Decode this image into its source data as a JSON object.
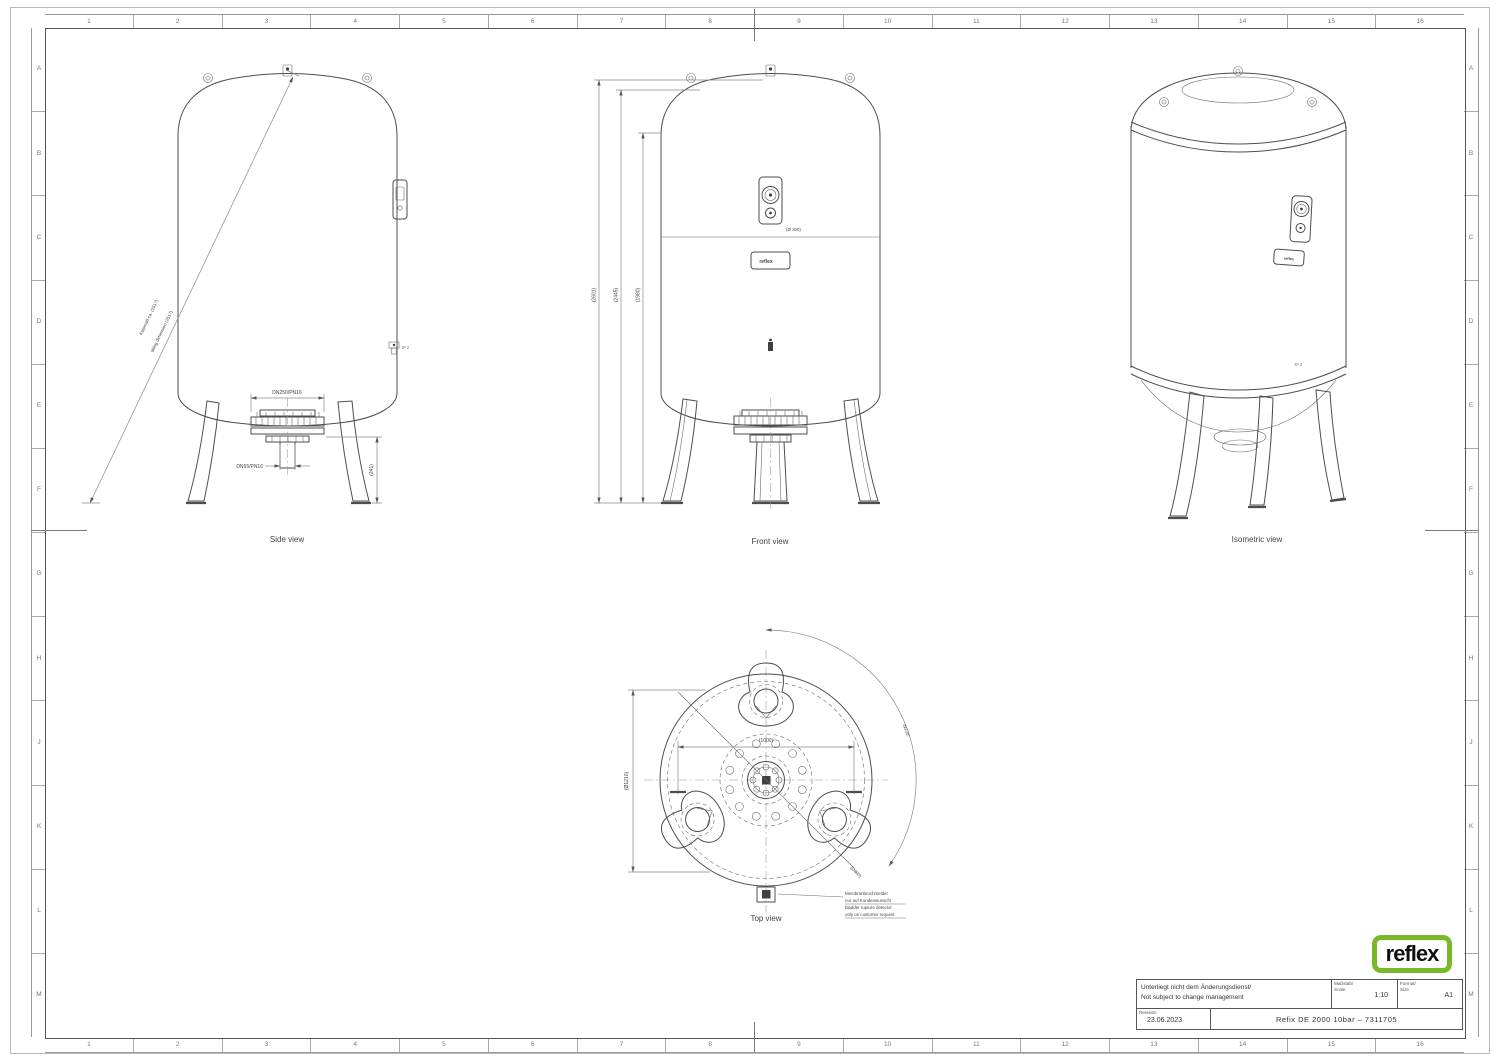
{
  "frame": {
    "columns": [
      "1",
      "2",
      "3",
      "4",
      "5",
      "6",
      "7",
      "8",
      "9",
      "10",
      "11",
      "12",
      "13",
      "14",
      "15",
      "16"
    ],
    "rows": [
      "A",
      "B",
      "C",
      "D",
      "E",
      "F",
      "G",
      "H",
      "J",
      "K",
      "L",
      "M"
    ]
  },
  "side_view": {
    "caption": "Side view",
    "tilt_dim_de": "Kippmaß ca. (2517)",
    "tilt_dim_en": "tilting dimension (2517)",
    "flange_dim": "DN250/PN16",
    "pipe_dim": "DN65/PN16",
    "height_dim": "(241)",
    "port_label": "TP 2"
  },
  "front_view": {
    "caption": "Front view",
    "dim_total": "(2601)",
    "dim_vessel": "(2445)",
    "dim_shell": "(1980)",
    "fitting_dim": "(Ø 200)",
    "nameplate": "reflex"
  },
  "iso_view": {
    "caption": "Isometric view",
    "port_label": "TP 2",
    "nameplate": "reflex"
  },
  "top_view": {
    "caption": "Top view",
    "dim_width": "(1000)",
    "dim_diameter": "(Ø1210)",
    "dim_legs": "3x120°",
    "dim_pitch": "(Ø860)",
    "note_line1": "Membranbruchmelder",
    "note_line2": "nur auf Kundenwunsch/",
    "note_line3": "bladder rupture detector",
    "note_line4": "only on customer request"
  },
  "title_block": {
    "logo": "reflex",
    "logo_color": "#78b829",
    "change_note_de": "Unterliegt nicht dem Änderungsdienst/",
    "change_note_en": "Not subject to change management",
    "scale_label_de": "Maßstab/",
    "scale_label_en": "Scale",
    "scale_value": "1:10",
    "format_label_de": "Format/",
    "format_label_en": "Size",
    "format_value": "A1",
    "revision_label": "Revision",
    "revision_date": "23.06.2023",
    "drawing_title": "Refix DE 2000 10bar – 7311705"
  }
}
